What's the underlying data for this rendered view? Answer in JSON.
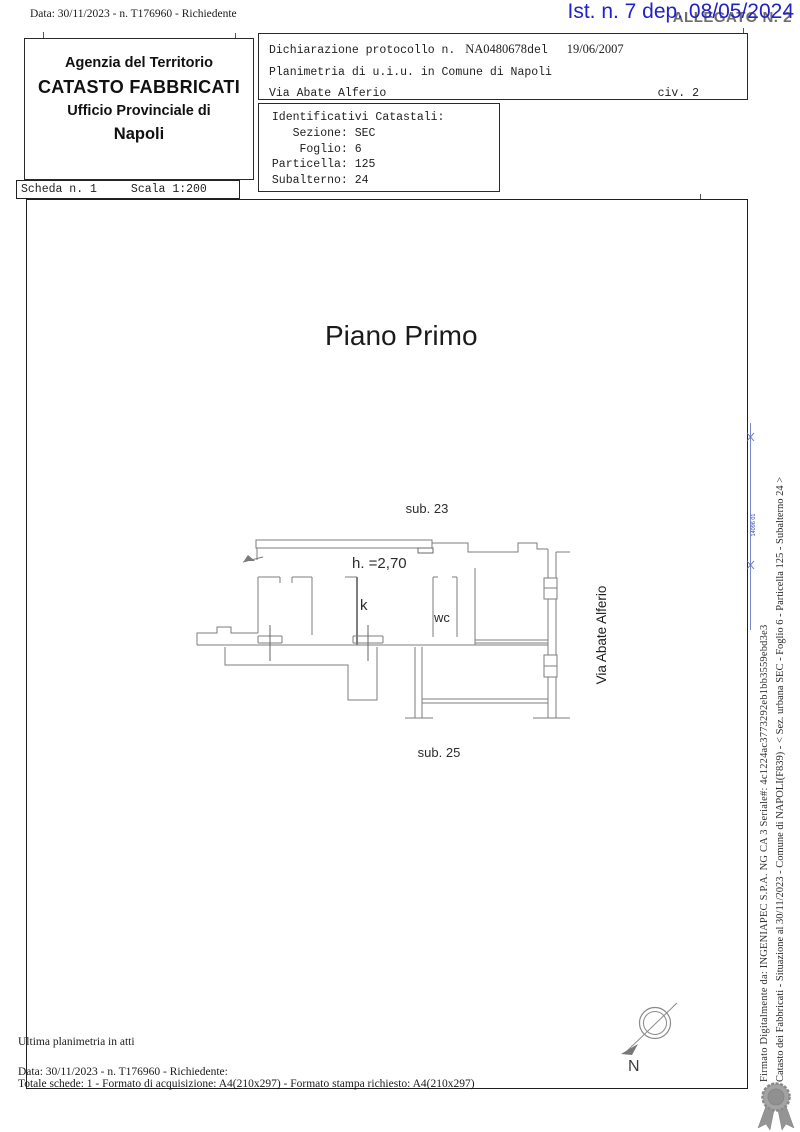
{
  "page": {
    "top_note": "Data: 30/11/2023 - n. T176960 - Richiedente",
    "stamp_blue": "Ist. n. 7 dep. 08/05/2024",
    "allegato": "ALLEGATO N. 2"
  },
  "header": {
    "office": {
      "line1": "Agenzia del Territorio",
      "line2": "CATASTO FABBRICATI",
      "line3": "Ufficio Provinciale di",
      "line4": "Napoli"
    },
    "declaration": {
      "protocol_label": "Dichiarazione protocollo n.",
      "protocol_number": "NA0480678",
      "protocol_del": "del",
      "protocol_date": "19/06/2007",
      "object_line": "Planimetria di u.i.u. in Comune di Napoli",
      "street": "Via Abate Alferio",
      "civic": "civ. 2"
    },
    "identifiers_block": " Identificativi Catastali:\n    Sezione: SEC\n     Foglio: 6\n Particella: 125\n Subalterno: 24",
    "scheda": {
      "left": "Scheda n. 1",
      "right": "Scala 1:200"
    }
  },
  "drawing": {
    "title": "Piano Primo",
    "labels": {
      "sub_top": "sub. 23",
      "height": "h. =2,70",
      "kitchen": "k",
      "wc": "wc",
      "sub_bottom": "sub. 25",
      "street_side": "Via Abate Alferio"
    },
    "compass": {
      "north": "N"
    }
  },
  "side_notes": {
    "situazione": "Catasto dei Fabbricati - Situazione al 30/11/2023 - Comune di NAPOLI(F839) - < Sez. urbana SEC -  Foglio 6 - Particella  125 - Subalterno 24 >",
    "firma": "Firmato Digitalmente da: INGENIAPEC S.P.A. NG CA 3 Seriale#: 4c1224ac3773292eb1bb3559ebd3e3",
    "blue_mark": "14096 01"
  },
  "footer": {
    "line1": "Ultima planimetria in atti",
    "line2": "Data: 30/11/2023 - n. T176960 - Richiedente:",
    "line3": "Totale schede: 1 - Formato di acquisizione: A4(210x297)  - Formato stampa richiesto: A4(210x297)"
  },
  "colors": {
    "stamp_blue": "#2121cd",
    "allegato_gray": "#6e6e6e",
    "plan_line_gray": "#7e7e7e",
    "frame_dark": "#1f1f1f",
    "seal_gray": "#969696",
    "ruler_blue": "#6b7cc4"
  }
}
